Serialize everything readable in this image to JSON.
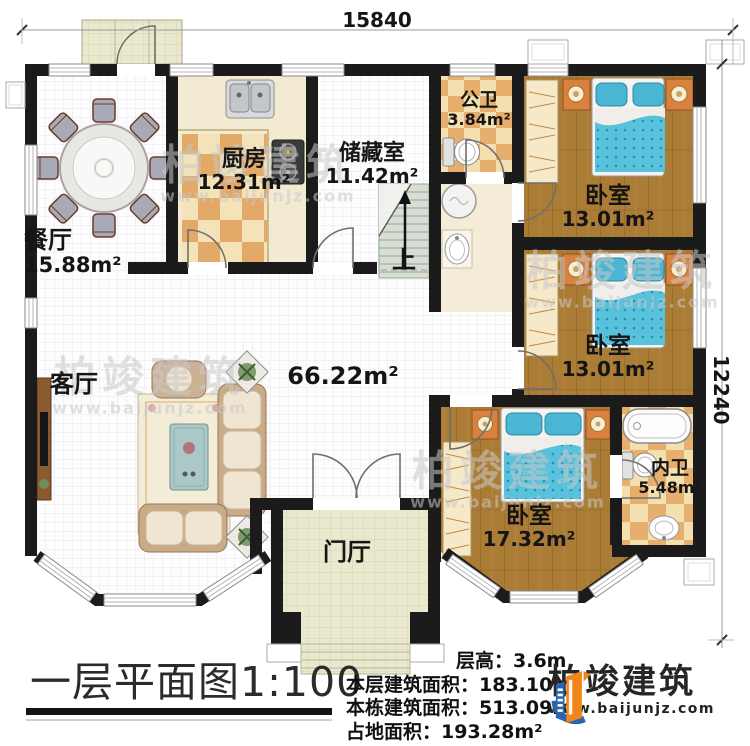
{
  "dimensions": {
    "width": "15840",
    "height": "12240"
  },
  "rooms": [
    {
      "name": "餐厅",
      "area": "15.88m²"
    },
    {
      "name": "厨房",
      "area": "12.31m²"
    },
    {
      "name": "储藏室",
      "area": "11.42m²"
    },
    {
      "name": "公卫",
      "area": "3.84m²"
    },
    {
      "name": "卧室",
      "area": "13.01m²"
    },
    {
      "name": "卧室",
      "area": "13.01m²"
    },
    {
      "name": "卧室",
      "area": "17.32m²"
    },
    {
      "name": "内卫",
      "area": "5.48m²"
    },
    {
      "name": "客厅"
    },
    {
      "name": "门厅"
    }
  ],
  "plan": {
    "open_area": "66.22m²",
    "stairs_up": "上"
  },
  "title": "一层平面图1:100",
  "specs": [
    {
      "label": "层高：",
      "value": "3.6m"
    },
    {
      "label": "本层建筑面积：",
      "value": "183.10m²"
    },
    {
      "label": "本栋建筑面积：",
      "value": "513.09m²"
    },
    {
      "label": "占地面积：",
      "value": "193.28m²"
    }
  ],
  "brand": {
    "name": "柏竣建筑",
    "site": "www.baijunjz.com"
  },
  "watermark": {
    "name": "柏竣建筑",
    "site": "www.baijunjz.com"
  },
  "colors": {
    "wall": "#1b1b1b",
    "wood": "#aa7c35",
    "checker_light": "#f4e3b8",
    "checker_dark": "#e2a968",
    "bed_blue": "#58c2dc",
    "brand_blue": "#2a66ad",
    "brand_orange": "#f08519"
  }
}
